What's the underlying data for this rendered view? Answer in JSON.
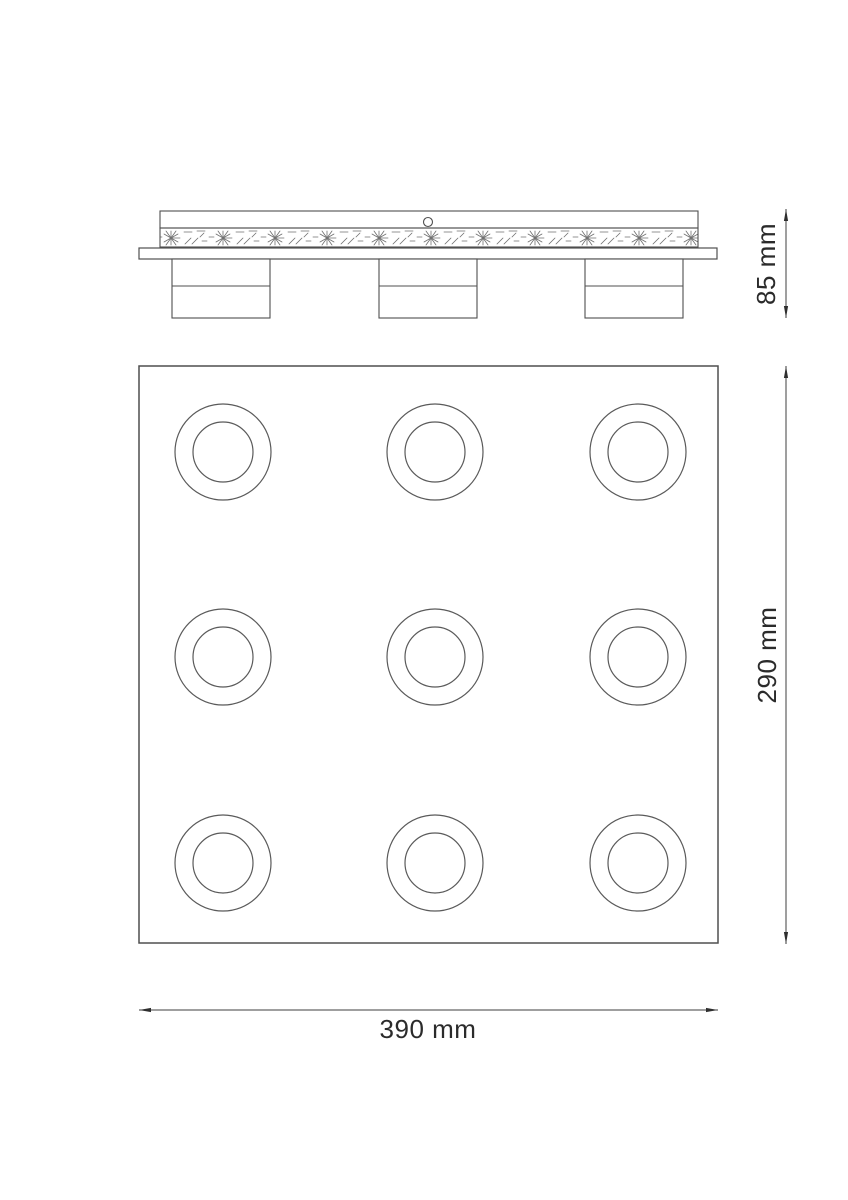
{
  "meta": {
    "title": "Ceiling lamp technical dimension drawing",
    "background_color": "#ffffff",
    "line_color": "#4f4f4f",
    "text_color": "#2b2b2b",
    "views": [
      "side-profile-view",
      "front-plate-view"
    ]
  },
  "side_view": {
    "description": "Side profile of ceiling mount: canopy with hatched band, cable hole, mounting plate and 3 spot housings",
    "spot_housing_count": 3,
    "height_dimension": {
      "label": "85 mm",
      "value": 85,
      "unit": "mm",
      "orientation": "vertical"
    }
  },
  "front_view": {
    "description": "Front view of square light plate with 3x3 grid of ring-shaped spot lenses",
    "grid": {
      "rows": 3,
      "cols": 3,
      "spot_count": 9
    },
    "height_dimension": {
      "label": "290 mm",
      "value": 290,
      "unit": "mm",
      "orientation": "vertical"
    },
    "width_dimension": {
      "label": "390 mm",
      "value": 390,
      "unit": "mm",
      "orientation": "horizontal"
    }
  }
}
